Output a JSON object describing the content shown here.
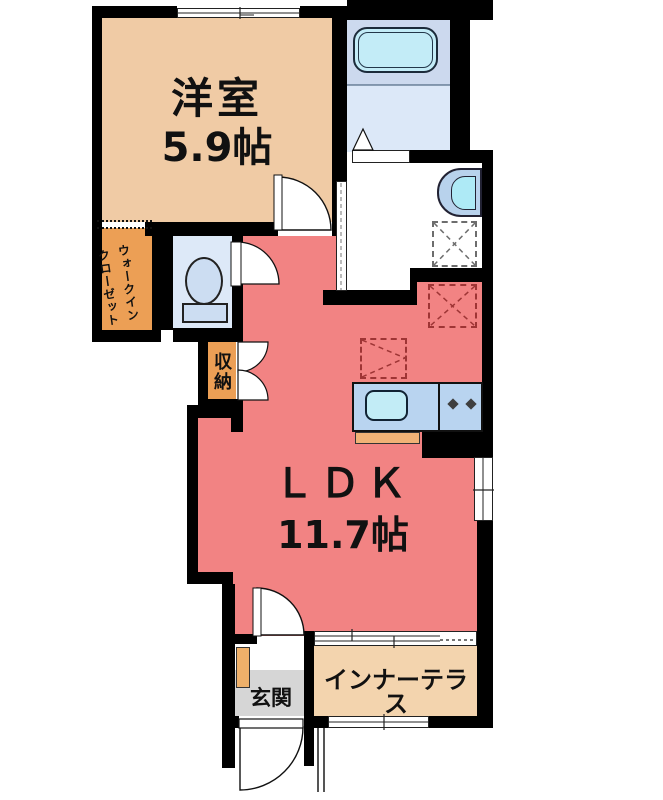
{
  "plan_type": "floorplan",
  "rooms": {
    "western": {
      "name": "洋室",
      "area": "5.9帖"
    },
    "ldk": {
      "name": "ＬＤＫ",
      "area": "11.7帖"
    },
    "wic": {
      "line1": "ウォークイン",
      "line2": "クローゼット"
    },
    "storage": {
      "name": "収納"
    },
    "entrance": {
      "name": "玄関"
    },
    "terrace": {
      "name": "インナーテラス"
    }
  },
  "fixtures": [
    "bathtub",
    "bath-folding-door",
    "washbasin",
    "washing-machine-space",
    "refrigerator-space",
    "kitchen-appliance-space",
    "kitchen-sink",
    "stove-burners",
    "kitchen-cabinet",
    "toilet",
    "shoe-cabinet",
    "entrance-door",
    "room-doors",
    "sliding-doors",
    "windows"
  ],
  "colors": {
    "wall": "#000000",
    "western": "#f0cba5",
    "wic": "#ec9f55",
    "storage": "#ec9f55",
    "shoebox": "#eeb06a",
    "cabinet": "#f0b276",
    "ldk": "#f28383",
    "terrace": "#f3d4ae",
    "bath_upper": "#ccd9ee",
    "bath_lower": "#dce8f8",
    "bathtub": "#c3ecf7",
    "toilet_floor": "#dde9f8",
    "toilet_fixture": "#ccddf2",
    "counter": "#b9d4f0",
    "sink": "#c2ecf6",
    "basin_outer": "#b8d2ec",
    "basin_inner": "#aeeaf6",
    "entrance_floor": "#d6d6d6"
  }
}
